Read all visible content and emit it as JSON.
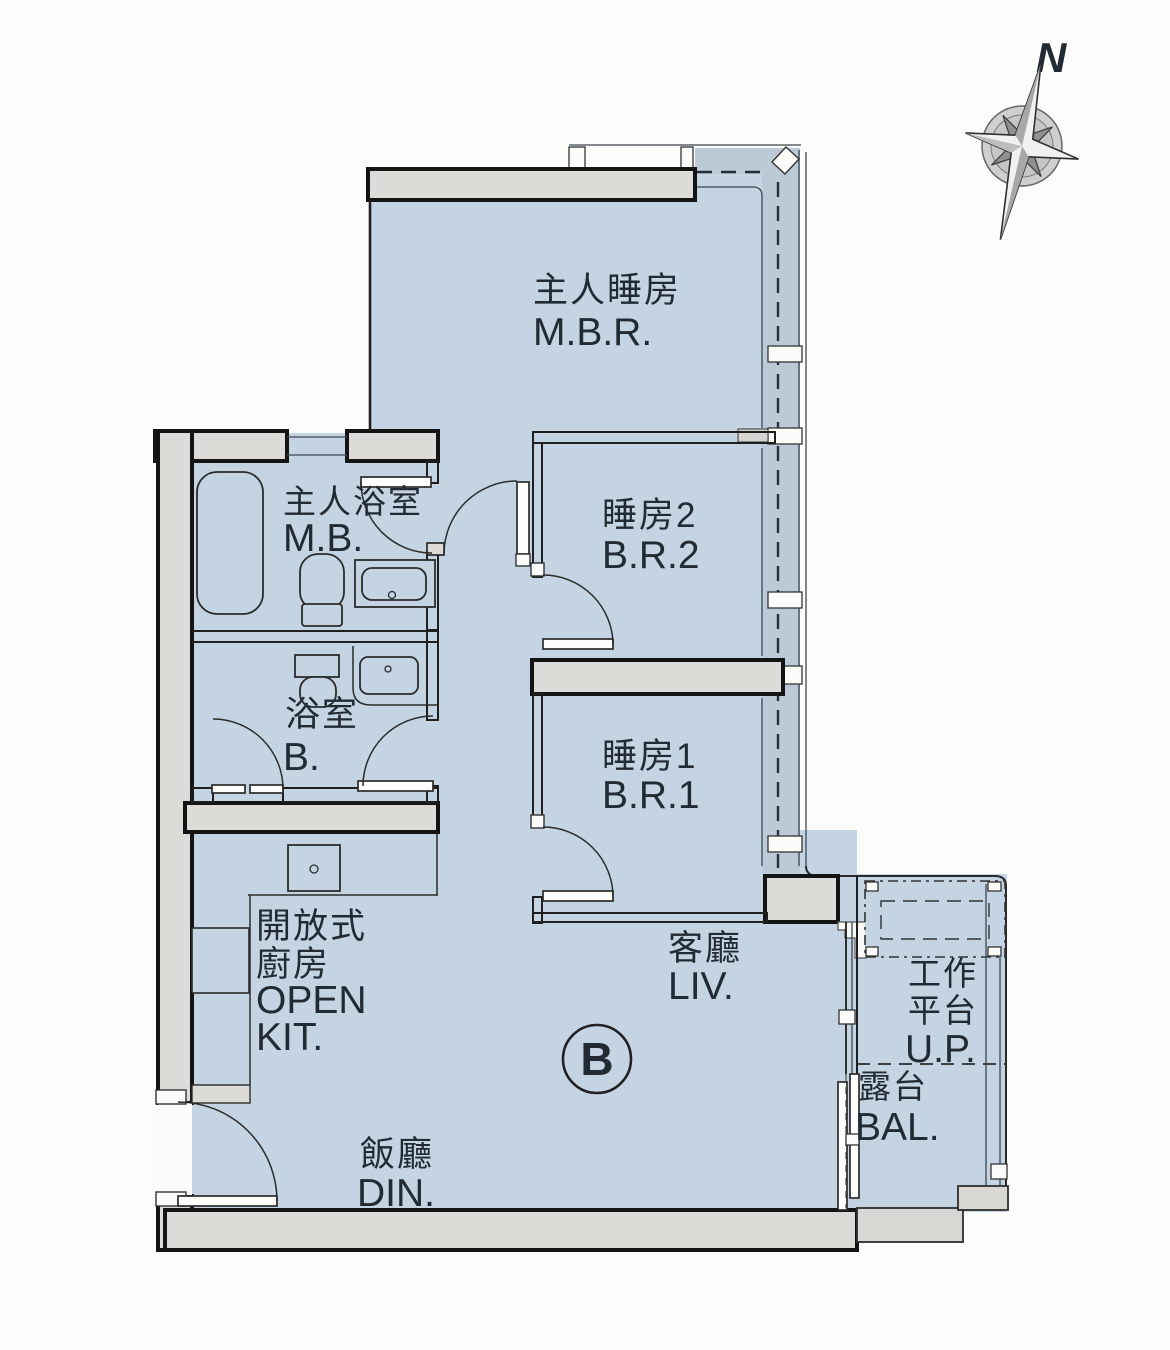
{
  "meta": {
    "type": "apartment-floor-plan",
    "unit": "B"
  },
  "compass": {
    "north_label": "N"
  },
  "unit_badge": "B",
  "rooms": {
    "master_bedroom": {
      "zh": "主人睡房",
      "en": "M.B.R."
    },
    "bedroom2": {
      "zh": "睡房2",
      "en": "B.R.2"
    },
    "bedroom1": {
      "zh": "睡房1",
      "en": "B.R.1"
    },
    "master_bath": {
      "zh": "主人浴室",
      "en": "M.B."
    },
    "bathroom": {
      "zh": "浴室",
      "en": "B."
    },
    "open_kitchen": {
      "zh1": "開放式",
      "zh2": "廚房",
      "en1": "OPEN",
      "en2": "KIT."
    },
    "living": {
      "zh": "客廳",
      "en": "LIV."
    },
    "dining": {
      "zh": "飯廳",
      "en": "DIN."
    },
    "utility_platform": {
      "zh1": "工作",
      "zh2": "平台",
      "en": "U.P."
    },
    "balcony": {
      "zh": "露台",
      "en": "BAL."
    }
  },
  "colors": {
    "room_fill": "#c4d4e2",
    "window_zone_fill": "#bcc9d7",
    "wall_fill": "#dcdbd7",
    "parapet_fill": "#d8d7d3",
    "line": "#1a1a1a",
    "text": "#222a33",
    "background": "#fcfcfb"
  }
}
